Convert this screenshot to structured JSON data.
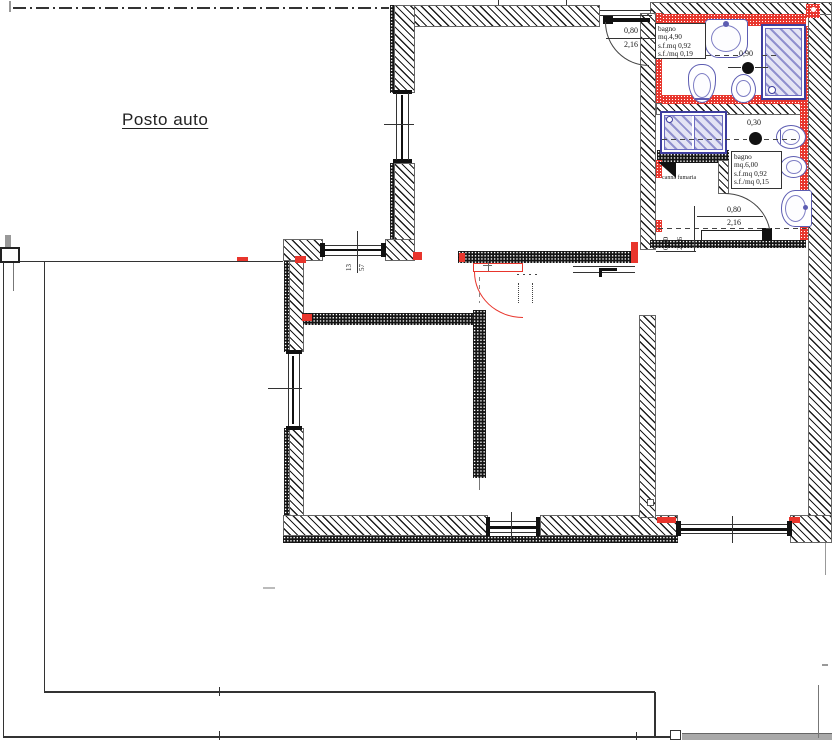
{
  "site": {
    "posto_auto_label": "Posto auto"
  },
  "bagno1": {
    "line1": "bagno",
    "line2": "mq.4,90",
    "line3": "s.f.mq 0,92",
    "line4": "s.f./mq 0,19",
    "door_width": "0,80",
    "door_height": "2,16",
    "shower_dim": "0,90"
  },
  "bagno2": {
    "line1": "bagno",
    "line2": "mq.6,00",
    "line3": "s.f.mq 0,92",
    "line4": "s.f./mq 0,15",
    "door_width": "0,80",
    "door_height": "2,16",
    "door_width_rot": "0,80",
    "door_height_rot": "2,16",
    "vent_dim": "0,30",
    "flue_label": "canna fumaria"
  },
  "window_north": {
    "dim_top": "13",
    "dim_bottom": "57"
  },
  "colors": {
    "accent_red": "#e8352c",
    "fixture_blue": "#5d5db2",
    "wall_black": "#1a1a1a"
  }
}
